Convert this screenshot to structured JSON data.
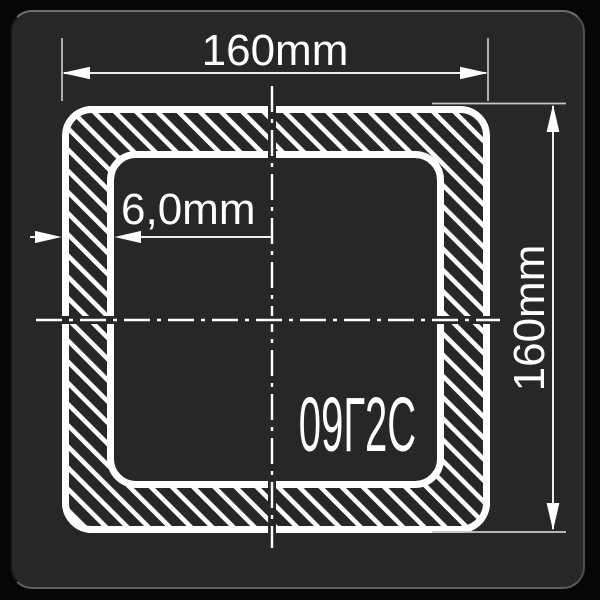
{
  "colors": {
    "canvas_bg": "#060606",
    "panel_bg": "#272727",
    "panel_edge_top": "#6e6e6e",
    "panel_edge_bottom": "#5e5e5e",
    "drawing_stroke": "#ffffff",
    "dimension_line": "#ededed",
    "extension_line": "#c8c8c8"
  },
  "drawing": {
    "subject": "square tube cross-section",
    "width_dimension": {
      "label": "160mm",
      "value_mm": 160
    },
    "height_dimension": {
      "label": "160mm",
      "value_mm": 160
    },
    "wall_thickness_dimension": {
      "label": "6,0mm",
      "value_mm": 6.0
    },
    "material_grade": {
      "label": "09Г2С"
    }
  }
}
